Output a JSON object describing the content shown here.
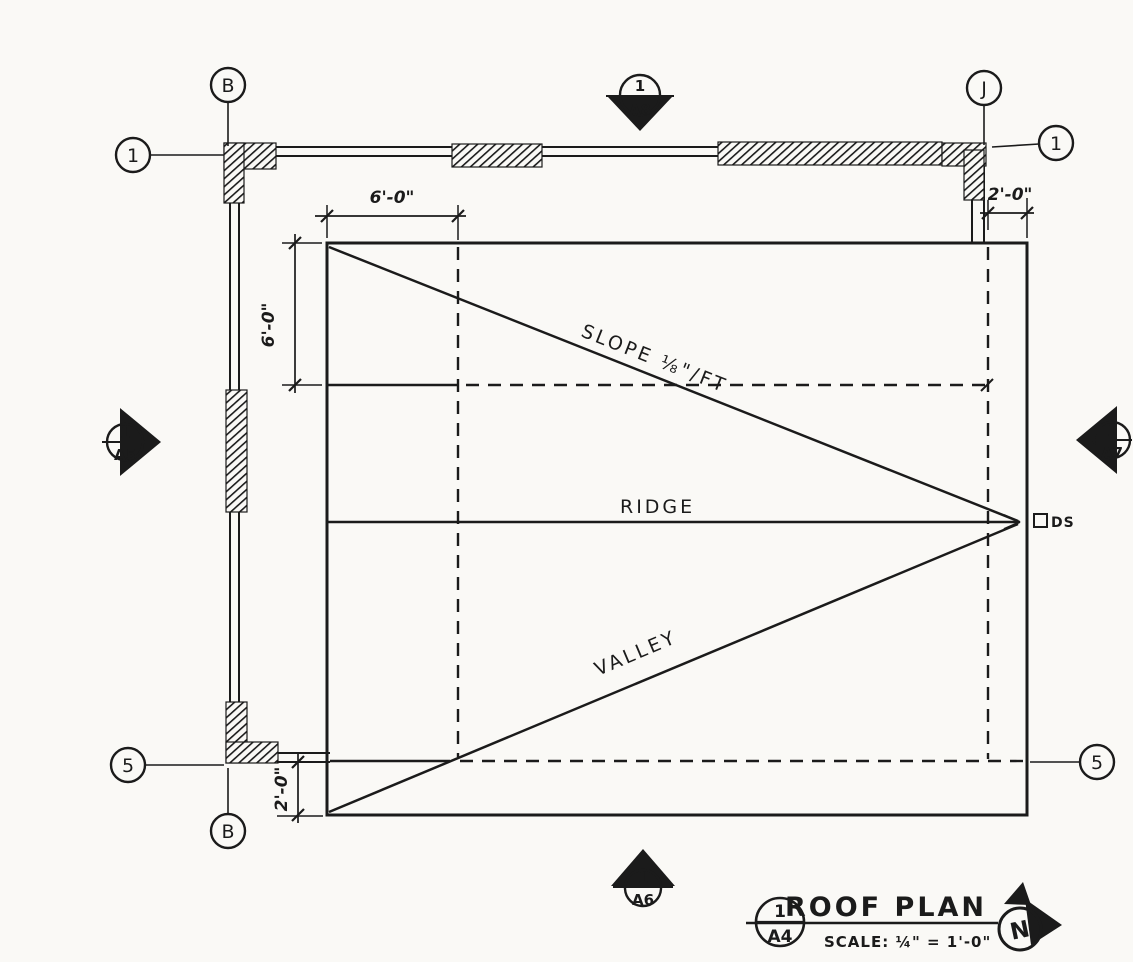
{
  "colors": {
    "ink": "#1b1b1b",
    "paper": "#faf9f6"
  },
  "title_block": {
    "detail_number": "1",
    "sheet_number": "A4",
    "title": "ROOF PLAN",
    "scale_note": "SCALE: ¼\" = 1'-0\"",
    "north_label": "N"
  },
  "labels": {
    "slope": "SLOPE ⅛\"/FT",
    "ridge": "RIDGE",
    "valley": "VALLEY",
    "downspout": "DS"
  },
  "dimensions": {
    "top_left_offset": "6'-0\"",
    "left_offset": "6'-0\"",
    "right_overhang": "2'-0\"",
    "bottom_overhang": "2'-0\""
  },
  "grid_bubbles": {
    "col_b_top": "B",
    "row_1_left": "1",
    "col_j_top": "J",
    "row_1_right": "1",
    "row_5_left": "5",
    "col_b_bottom": "B",
    "row_5_right": "5"
  },
  "section_markers": {
    "top": {
      "number": "1",
      "sheet": "A8"
    },
    "left": {
      "number": "1",
      "sheet": "A5"
    },
    "right": {
      "number": "1",
      "sheet": "A7"
    },
    "bottom": {
      "number": "1",
      "sheet": "A6"
    }
  }
}
